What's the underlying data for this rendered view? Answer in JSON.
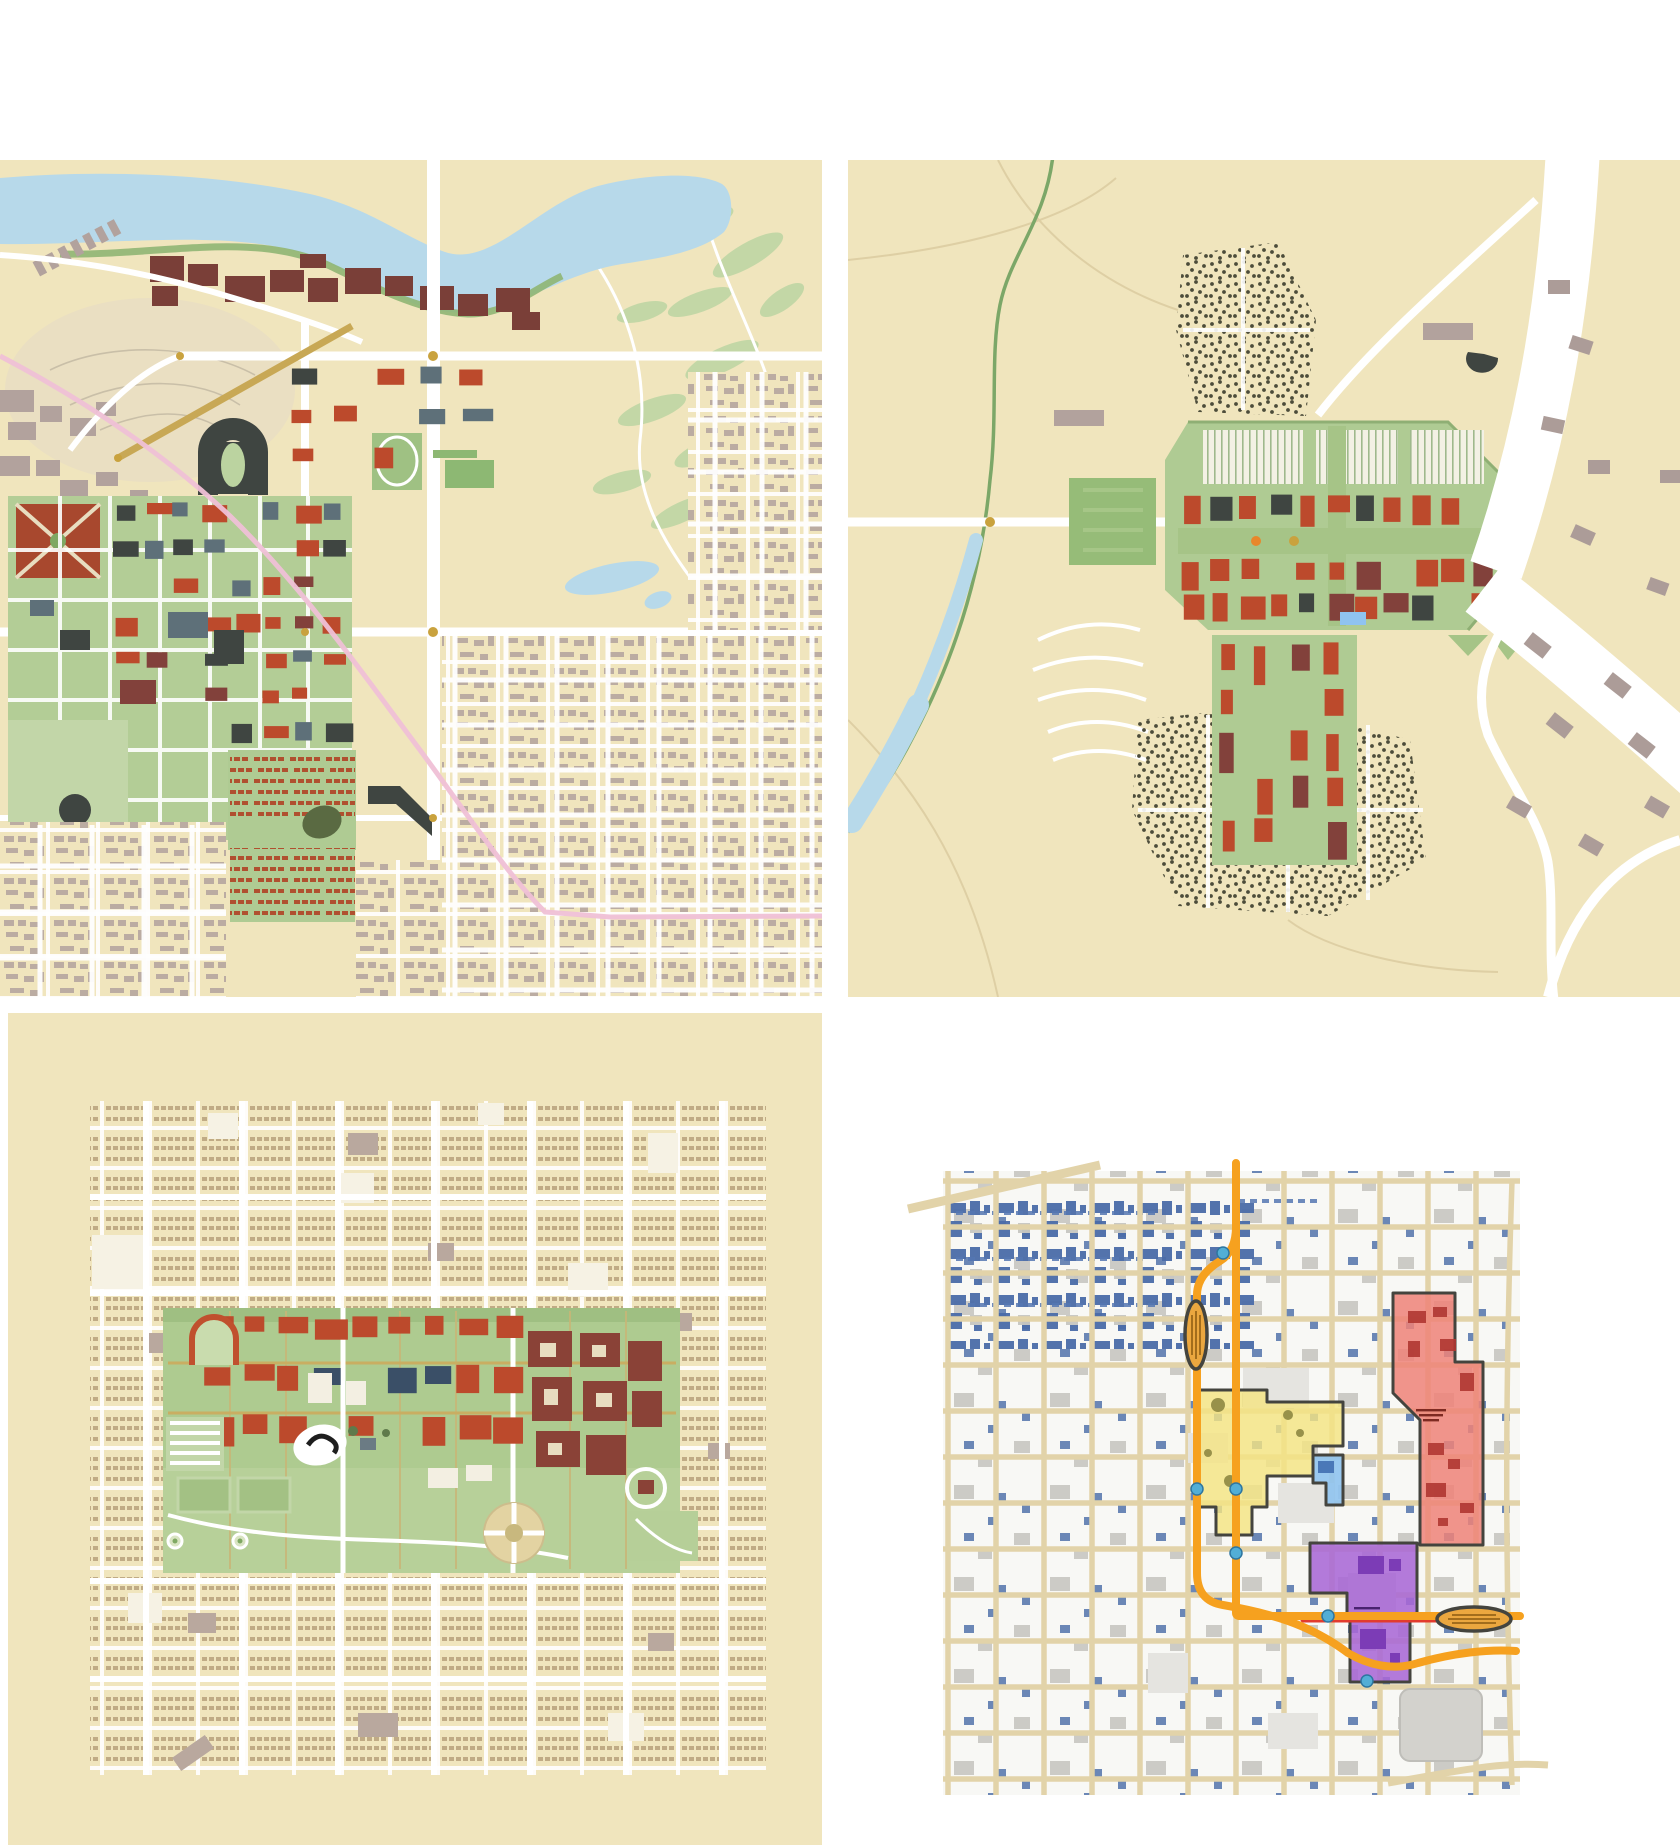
{
  "page": {
    "background": "#FFFFFF",
    "description_visible_text": "",
    "figure_count": 4
  },
  "palette": {
    "tan": "#F0E5BD",
    "tan_light": "#EADFC2",
    "street_tan": "#E2D3A9",
    "river_blue": "#B7D9EA",
    "green_field": "#96BC78",
    "green_mall": "#AFCB93",
    "green_campus": "#AECB90",
    "green_light": "#C3D7A6",
    "green_dark": "#7FA863",
    "brick": "#BC4A2C",
    "maroon": "#82413B",
    "riverfront_maroon": "#7A3F38",
    "charcoal": "#3F4541",
    "slate": "#5E7079",
    "navy": "#3A4F67",
    "mauve": "#B2A29D",
    "gold": "#C8A855",
    "pink_line": "#EFC0D6",
    "block_white": "#F8F8F5",
    "bldg_gray": "#C7C6C1",
    "bldg_blue": "#4A6CA8",
    "district_yellow": "#F4E483",
    "district_red": "#EF8278",
    "district_red_building": "#B03732",
    "district_blue": "#8FC3F0",
    "district_purple": "#A868D6",
    "district_purple_building": "#7C3CB6",
    "route_orange": "#F6A11F",
    "route_red": "#E23B2E",
    "station_fill": "#EBA73F",
    "outline_dark": "#44443E",
    "stop_dot": "#52AED6"
  },
  "maps": {
    "top_left": {
      "name": "campus-plan-river-north",
      "background": "#F0E5BD",
      "has_text": false
    },
    "top_right": {
      "name": "campus-plan-creek-west",
      "background": "#F0E5BD",
      "has_text": false
    },
    "bottom_left": {
      "name": "campus-plan-green-band",
      "background": "#F0E5BD",
      "has_text": false
    },
    "bottom_right": {
      "name": "downtown-district-plan",
      "background": "#FFFFFF",
      "districts": [
        {
          "name": "yellow-district",
          "color": "#F4E483"
        },
        {
          "name": "red-district",
          "color": "#EF8278"
        },
        {
          "name": "blue-district",
          "color": "#8FC3F0"
        },
        {
          "name": "purple-district",
          "color": "#A868D6"
        }
      ],
      "route_color": "#F6A11F",
      "station_count": 2,
      "stop_dot_color": "#52AED6"
    }
  }
}
